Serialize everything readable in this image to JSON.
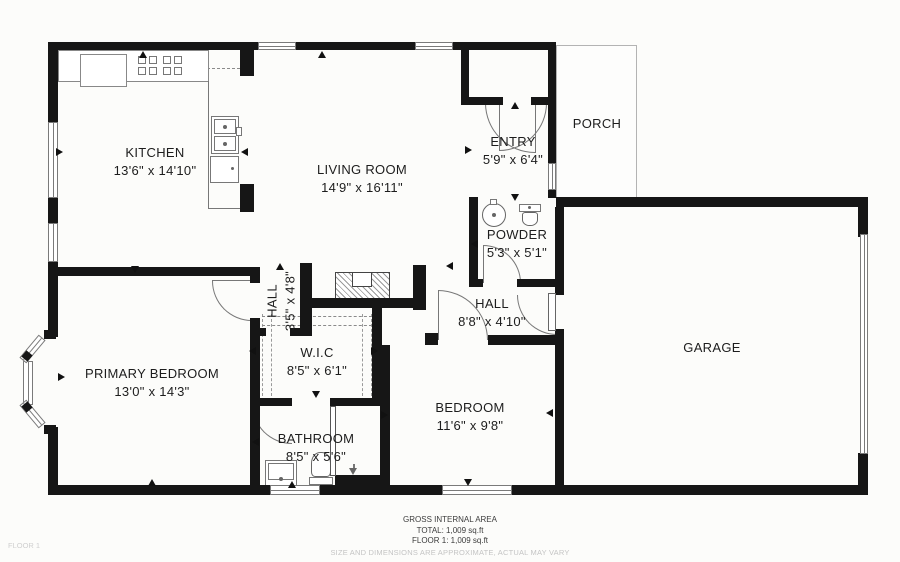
{
  "plan": {
    "rooms": {
      "kitchen": {
        "name": "KITCHEN",
        "dims": "13'6\" x 14'10\""
      },
      "living": {
        "name": "LIVING ROOM",
        "dims": "14'9\" x 16'11\""
      },
      "entry": {
        "name": "ENTRY",
        "dims": "5'9\" x 6'4\""
      },
      "porch": {
        "name": "PORCH"
      },
      "powder": {
        "name": "POWDER",
        "dims": "5'3\" x 5'1\""
      },
      "hall_main": {
        "name": "HALL",
        "dims": "8'8\" x 4'10\""
      },
      "hall_small": {
        "name": "HALL",
        "dims": "3'5\" x 4'8\""
      },
      "wic": {
        "name": "W.I.C",
        "dims": "8'5\" x 6'1\""
      },
      "primary": {
        "name": "PRIMARY BEDROOM",
        "dims": "13'0\" x 14'3\""
      },
      "bathroom": {
        "name": "BATHROOM",
        "dims": "8'5\" x 5'6\""
      },
      "bedroom": {
        "name": "BEDROOM",
        "dims": "11'6\" x 9'8\""
      },
      "garage": {
        "name": "GARAGE"
      }
    },
    "footer": {
      "title": "GROSS INTERNAL AREA",
      "total": "TOTAL: 1,009 sq.ft",
      "floor": "FLOOR 1: 1,009 sq.ft",
      "disclaimer": "SIZE AND DIMENSIONS ARE APPROXIMATE, ACTUAL MAY VARY",
      "floor_tag": "FLOOR 1"
    },
    "colors": {
      "wall": "#161616",
      "text": "#1d1d1d",
      "muted": "#c4c4c4",
      "background": "#fcfcfa"
    }
  }
}
